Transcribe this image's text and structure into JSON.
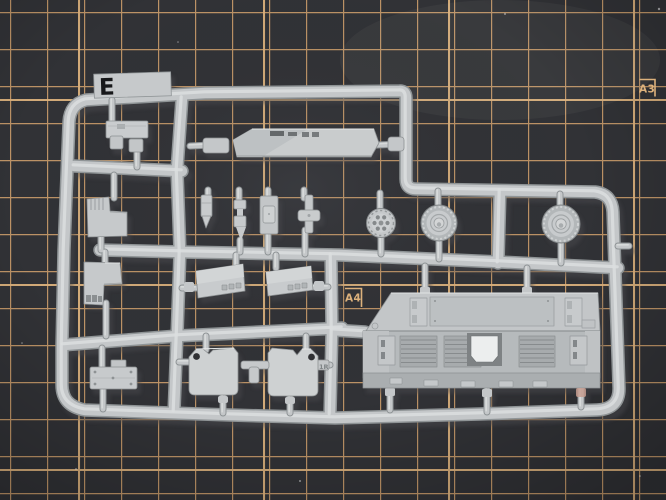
{
  "scene": {
    "subject": "Light grey injection-moulded model kit sprue (runner E) lying on a dark self-healing cutting mat",
    "view": "top-down photograph"
  },
  "cutting_mat": {
    "surface_color": "#313236",
    "grid_line_color": "#bd9366",
    "grid_major_line_color": "#dcb17c",
    "label_color": "#dcb17c",
    "size_marks": {
      "a3": "A3",
      "a4": "A4"
    }
  },
  "sprue": {
    "runner_letter": "E",
    "letter_color": "#17181a",
    "plastic_color": "#c4c7c9",
    "plastic_edge_color": "#8f9496",
    "plastic_highlight_color": "#dcdedf",
    "molded_marking": "1R",
    "parts": [
      "hull fitting with clips",
      "glacis panel",
      "upper L-shaped bracket",
      "lower L-shaped bracket",
      "bolted access plate",
      "stowage box (left)",
      "stowage box (right)",
      "mud flap (left)",
      "mud flap (right)",
      "cross joint connector",
      "shock absorber",
      "link rod",
      "mounting strip",
      "stem with cross head",
      "drive sprocket wheel",
      "road wheel (inner)",
      "road wheel (outer)",
      "engine deck panel"
    ]
  }
}
